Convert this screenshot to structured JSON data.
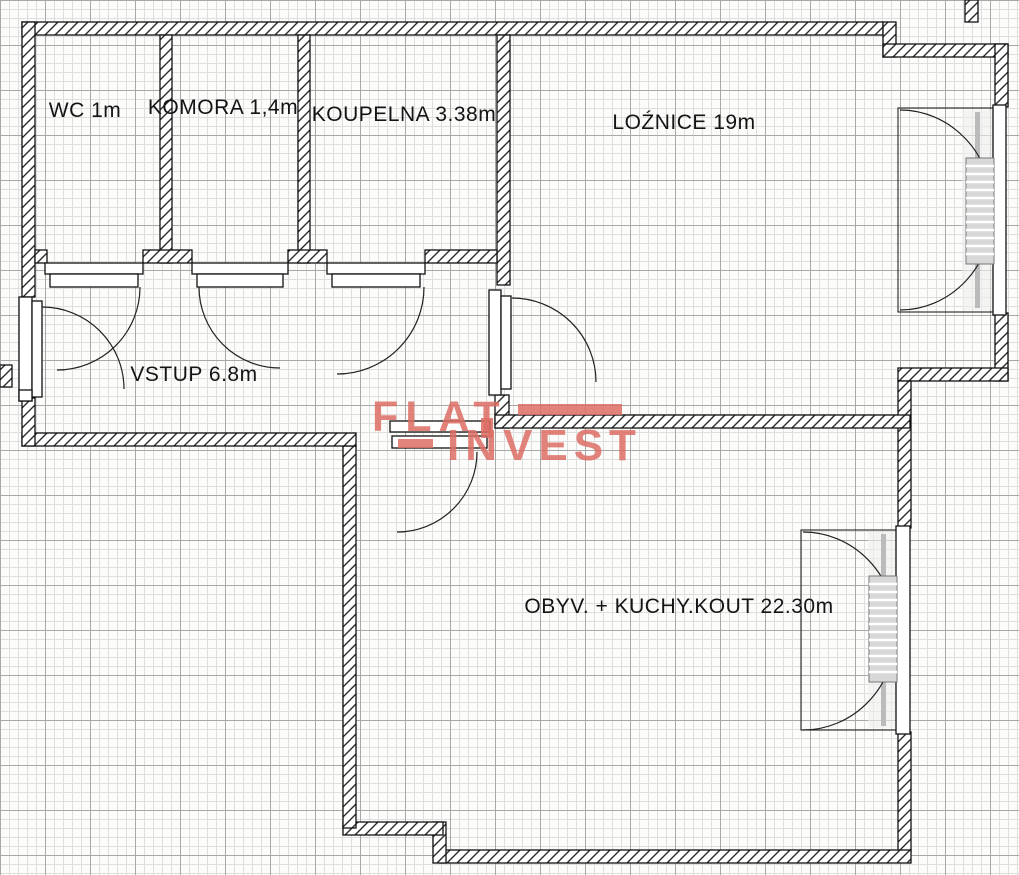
{
  "floorplan": {
    "rooms": [
      {
        "name": "wc",
        "label": "WC 1m"
      },
      {
        "name": "komora",
        "label": "KOMORA 1,4m"
      },
      {
        "name": "koupelna",
        "label": "KOUPELNA 3.38m"
      },
      {
        "name": "loznice",
        "label": "LOŹNICE 19m"
      },
      {
        "name": "vstup",
        "label": "VSTUP 6.8m"
      },
      {
        "name": "obyv",
        "label": "OBYV. + KUCHY.KOUT 22.30m"
      }
    ],
    "watermark": {
      "line1": "FLAT",
      "line2": "INVEST",
      "color": "#dd6d64"
    },
    "symbols": {
      "door": "quarter-arc-swing-with-leaf",
      "window": "double-casement-arcs",
      "radiator": "ribbed-rectangle",
      "wall": "diagonal-hatched-strip"
    },
    "colors": {
      "paper": "#fcfcfa",
      "grid_minor": "#dedede",
      "grid_major": "#a8a8a8",
      "wall_outline": "#111111",
      "wall_hatch": "#2b2b2b",
      "wall_fill": "#ffffff",
      "label_text": "#141414",
      "radiator_fill": "#d8d8d8",
      "logo": "#dd6d64"
    }
  }
}
